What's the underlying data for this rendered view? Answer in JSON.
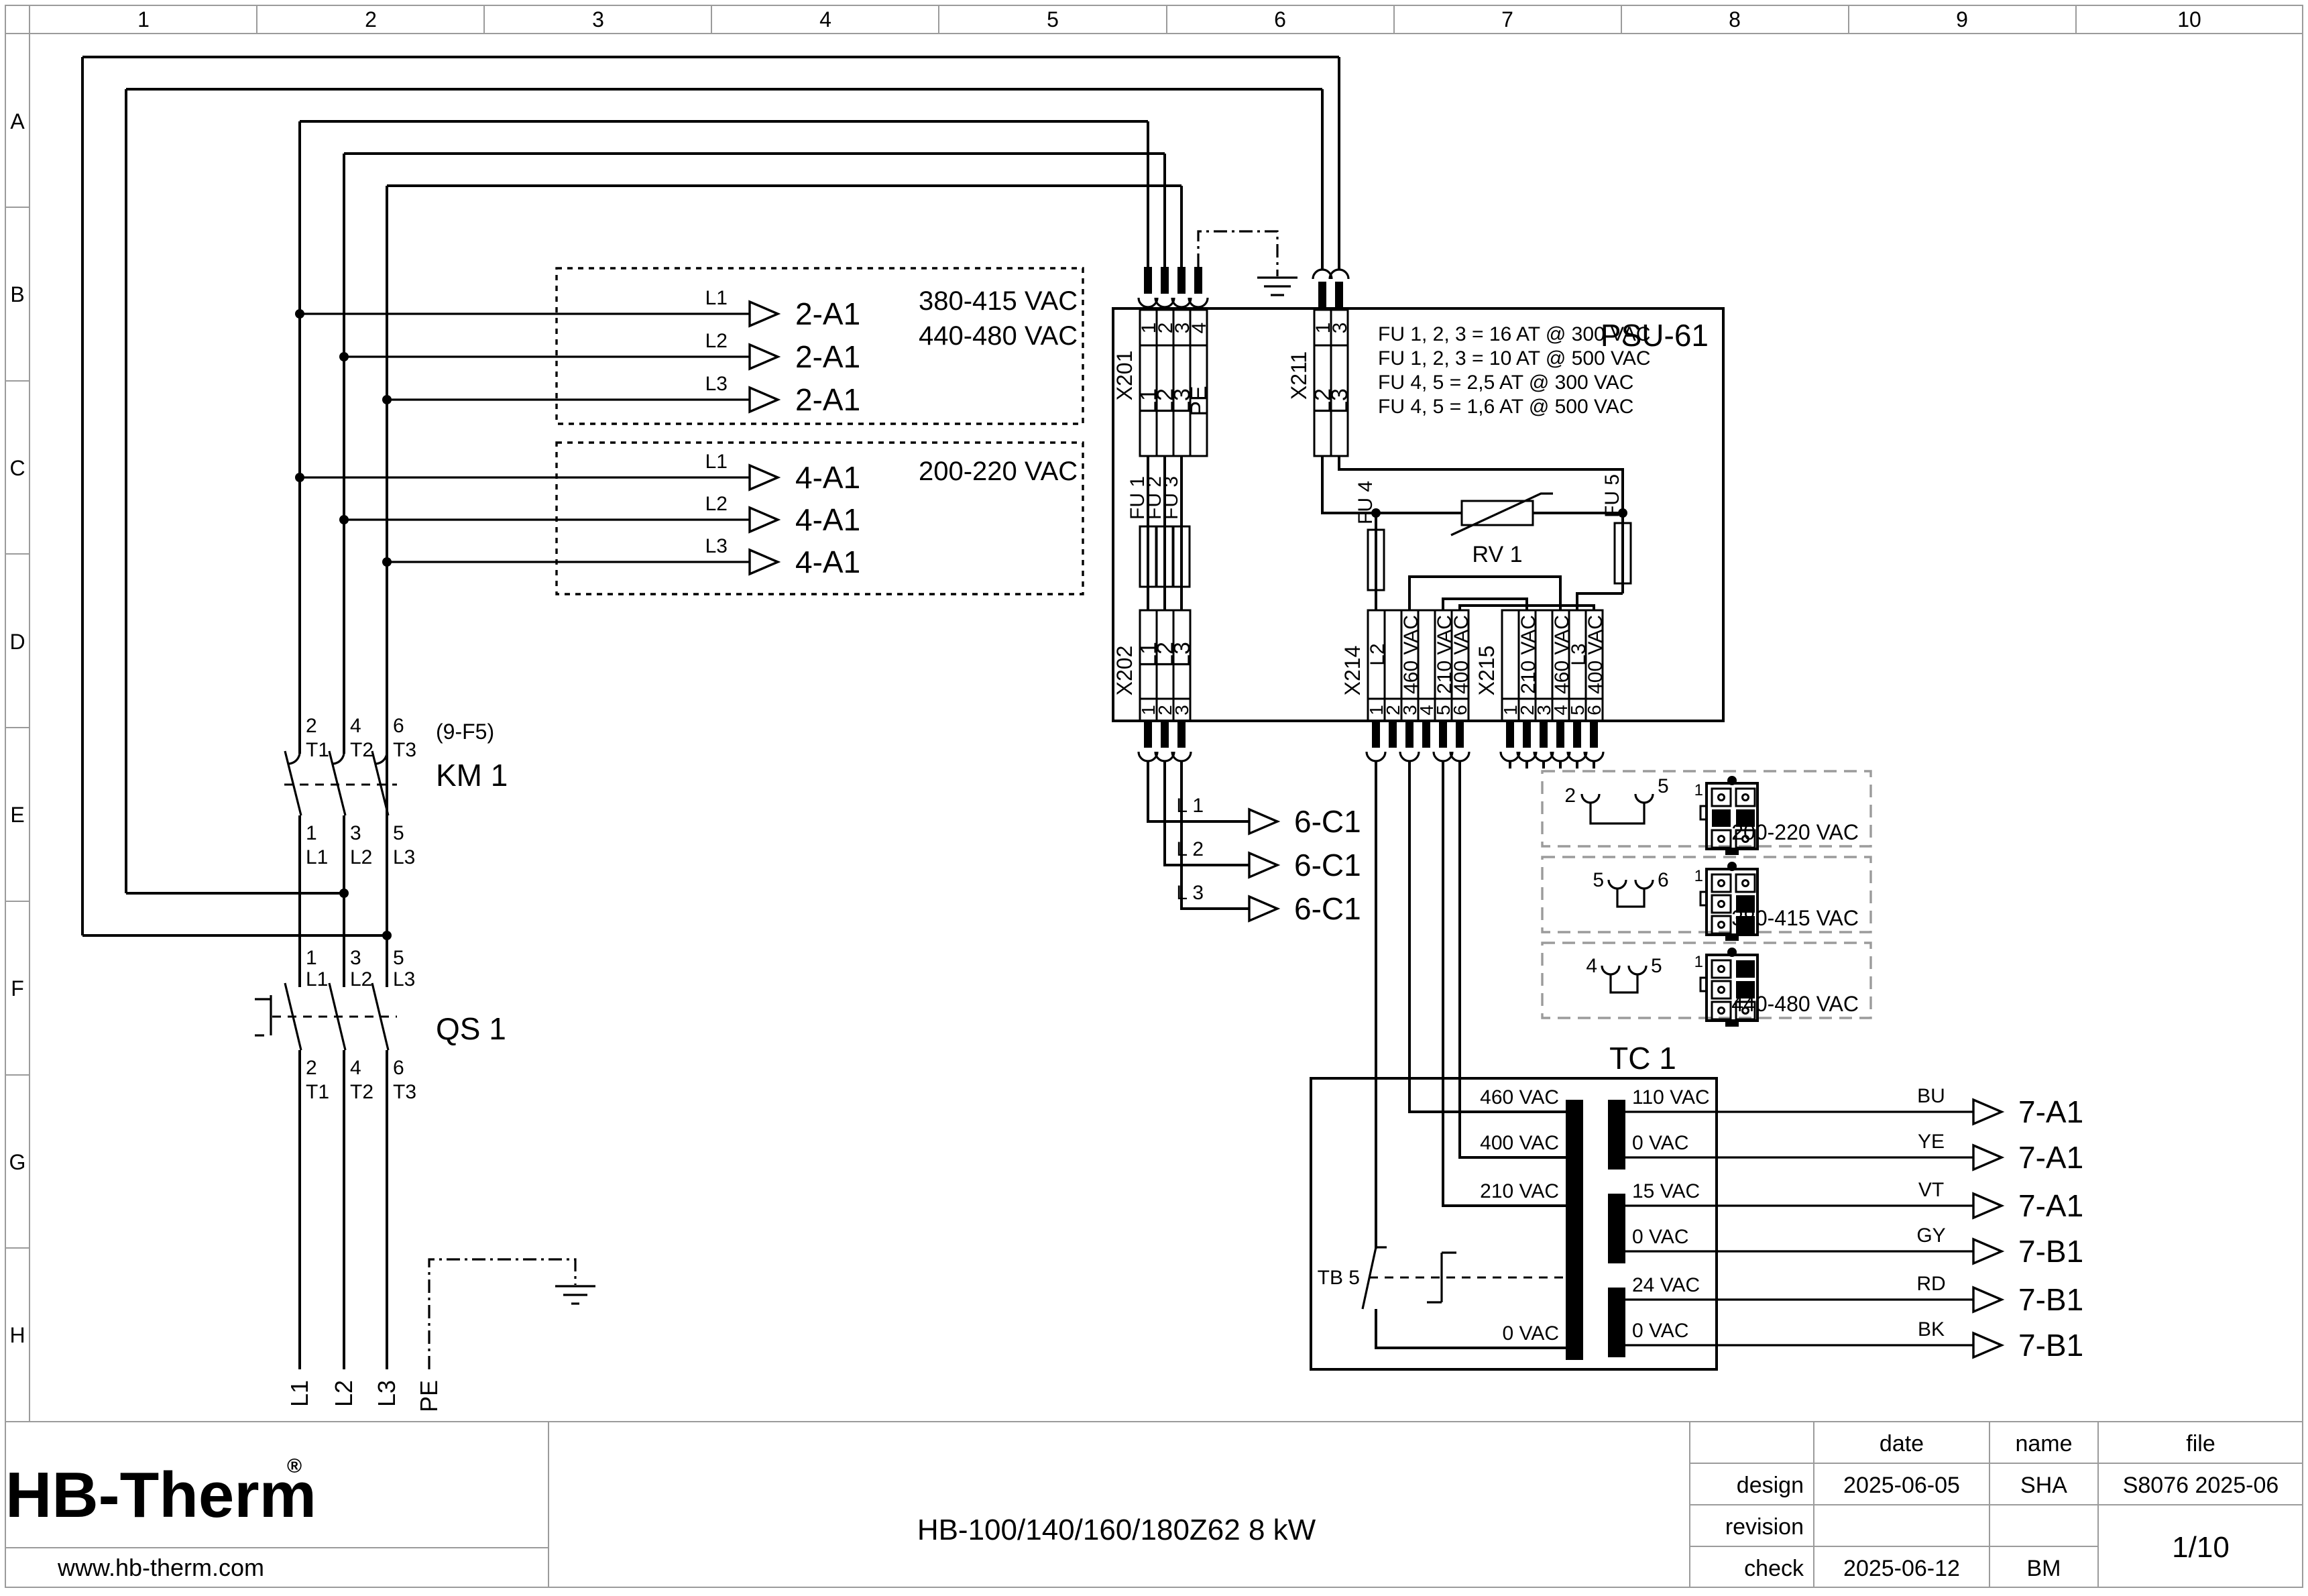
{
  "ruler": {
    "columns": [
      "1",
      "2",
      "3",
      "4",
      "5",
      "6",
      "7",
      "8",
      "9",
      "10"
    ],
    "rows": [
      "A",
      "B",
      "C",
      "D",
      "E",
      "F",
      "G",
      "H"
    ]
  },
  "feeds": {
    "group1": {
      "lines": [
        {
          "phase": "L1",
          "target": "2-A1"
        },
        {
          "phase": "L2",
          "target": "2-A1"
        },
        {
          "phase": "L3",
          "target": "2-A1"
        }
      ],
      "voltage1": "380-415 VAC",
      "voltage2": "440-480 VAC"
    },
    "group2": {
      "lines": [
        {
          "phase": "L1",
          "target": "4-A1"
        },
        {
          "phase": "L2",
          "target": "4-A1"
        },
        {
          "phase": "L3",
          "target": "4-A1"
        }
      ],
      "voltage": "200-220 VAC"
    }
  },
  "psu": {
    "ref": "PSU-61",
    "fuse_notes": [
      "FU 1, 2, 3 = 16 AT @ 300 VAC",
      "FU 1, 2, 3 = 10 AT @ 500 VAC",
      "FU 4, 5 = 2,5 AT @ 300 VAC",
      "FU 4, 5 = 1,6 AT @ 500 VAC"
    ],
    "x201": {
      "ref": "X201",
      "pins": [
        "1",
        "2",
        "3",
        "4"
      ],
      "labels": [
        "L1",
        "L2",
        "L3",
        "PE"
      ]
    },
    "x211": {
      "ref": "X211",
      "pins": [
        "1",
        "3"
      ],
      "labels": [
        "L2",
        "L3"
      ]
    },
    "x202": {
      "ref": "X202",
      "pins": [
        "1",
        "2",
        "3"
      ],
      "labels": [
        "L1",
        "L2",
        "L3"
      ]
    },
    "x214": {
      "ref": "X214",
      "pins": [
        "1",
        "2",
        "3",
        "4",
        "5",
        "6"
      ],
      "labels": [
        "L2",
        "",
        "460 VAC",
        "",
        "210 VAC",
        "400 VAC"
      ]
    },
    "x215": {
      "ref": "X215",
      "pins": [
        "1",
        "2",
        "3",
        "4",
        "5",
        "6"
      ],
      "labels": [
        "",
        "210 VAC",
        "",
        "460 VAC",
        "L3",
        "400 VAC"
      ]
    },
    "fuses": [
      "FU 1",
      "FU 2",
      "FU 3",
      "FU 4",
      "FU 5"
    ],
    "rv1": "RV 1"
  },
  "km1": {
    "ref": "KM 1",
    "note": "(9-F5)",
    "top": [
      {
        "no": "2",
        "t": "T1"
      },
      {
        "no": "4",
        "t": "T2"
      },
      {
        "no": "6",
        "t": "T3"
      }
    ],
    "bottom": [
      {
        "no": "1",
        "t": "L1"
      },
      {
        "no": "3",
        "t": "L2"
      },
      {
        "no": "5",
        "t": "L3"
      }
    ]
  },
  "qs1": {
    "ref": "QS 1",
    "top": [
      {
        "no": "1",
        "t": "L1"
      },
      {
        "no": "3",
        "t": "L2"
      },
      {
        "no": "5",
        "t": "L3"
      }
    ],
    "bottom": [
      {
        "no": "2",
        "t": "T1"
      },
      {
        "no": "4",
        "t": "T2"
      },
      {
        "no": "6",
        "t": "T3"
      }
    ]
  },
  "mains": [
    "L1",
    "L2",
    "L3",
    "PE"
  ],
  "control_feeds": [
    {
      "phase": "L 1",
      "target": "6-C1"
    },
    {
      "phase": "L 2",
      "target": "6-C1"
    },
    {
      "phase": "L 3",
      "target": "6-C1"
    }
  ],
  "jumper_options": [
    {
      "pin_a": "2",
      "pin_b": "5",
      "connector_pin": "1",
      "voltage": "200-220 VAC"
    },
    {
      "pin_a": "5",
      "pin_b": "6",
      "connector_pin": "1",
      "voltage": "380-415 VAC"
    },
    {
      "pin_a": "4",
      "pin_b": "5",
      "connector_pin": "1",
      "voltage": "440-480 VAC"
    }
  ],
  "tc1": {
    "ref": "TC 1",
    "thermal": "TB 5",
    "primary": [
      "460 VAC",
      "400 VAC",
      "210 VAC",
      "0 VAC"
    ],
    "secondary": [
      {
        "tap": "110 VAC",
        "wire": "BU",
        "target": "7-A1"
      },
      {
        "tap": "0 VAC",
        "wire": "YE",
        "target": "7-A1"
      },
      {
        "tap": "15 VAC",
        "wire": "VT",
        "target": "7-A1"
      },
      {
        "tap": "0 VAC",
        "wire": "GY",
        "target": "7-B1"
      },
      {
        "tap": "24 VAC",
        "wire": "RD",
        "target": "7-B1"
      },
      {
        "tap": "0 VAC",
        "wire": "BK",
        "target": "7-B1"
      }
    ]
  },
  "title_block": {
    "logo": "HB-Therm",
    "registered": "®",
    "website": "www.hb-therm.com",
    "doc_title": "HB-100/140/160/180Z62 8 kW",
    "headers": {
      "date": "date",
      "name": "name",
      "file": "file"
    },
    "rows": [
      {
        "label": "design",
        "date": "2025-06-05",
        "name": "SHA"
      },
      {
        "label": "revision",
        "date": "",
        "name": ""
      },
      {
        "label": "check",
        "date": "2025-06-12",
        "name": "BM"
      }
    ],
    "file_no": "S8076 2025-06",
    "page": "1/10"
  },
  "colors": {
    "line": "#000000",
    "logo": "#17294d",
    "frame": "#9b9b9b"
  }
}
